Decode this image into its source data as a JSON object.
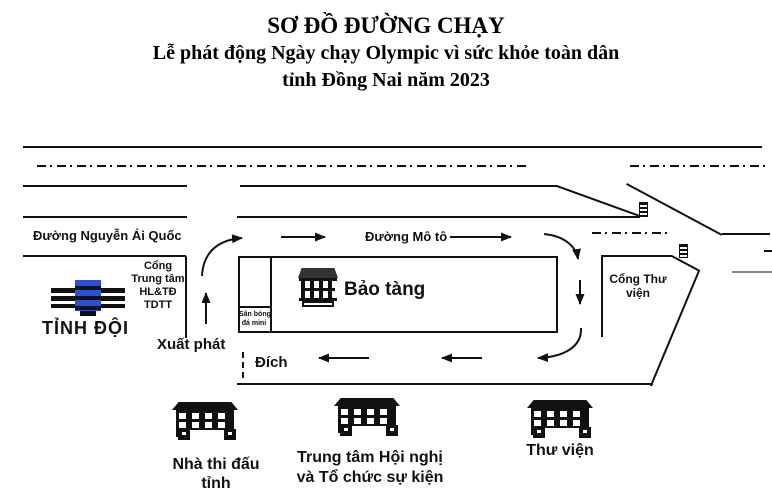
{
  "title": {
    "line1": "SƠ ĐỒ ĐƯỜNG CHẠY",
    "line2": "Lễ phát động Ngày chạy Olympic vì sức khỏe toàn dân",
    "line3": "tỉnh Đồng Nai năm 2023"
  },
  "map": {
    "streets": {
      "nguyen_ai_quoc": "Đường Nguyễn Ái Quốc",
      "mo_to": "Đường Mô tô"
    },
    "labels": {
      "cong_trung_tam": {
        "l1": "Cổng",
        "l2": "Trung tâm",
        "l3": "HL&TĐ",
        "l4": "TDTT"
      },
      "tinh_doi": "TỈNH ĐỘI",
      "bao_tang": "Bảo tàng",
      "san_bong": {
        "l1": "Sân bóng",
        "l2": "đá mini"
      },
      "xuat_phat": "Xuất phát",
      "dich": "Đích",
      "cong_thu_vien": {
        "l1": "Cổng Thư",
        "l2": "viện"
      }
    },
    "venues": [
      {
        "name_l1": "Nhà thi đấu",
        "name_l2": "tỉnh"
      },
      {
        "name_l1": "Trung tâm Hội nghị",
        "name_l2": "và Tổ chức sự kiện"
      },
      {
        "name_l1": "Thư viện",
        "name_l2": ""
      }
    ],
    "colors": {
      "line": "#111111",
      "gray_line": "#888888",
      "tinh_doi_blue": "#2a50d8"
    }
  }
}
